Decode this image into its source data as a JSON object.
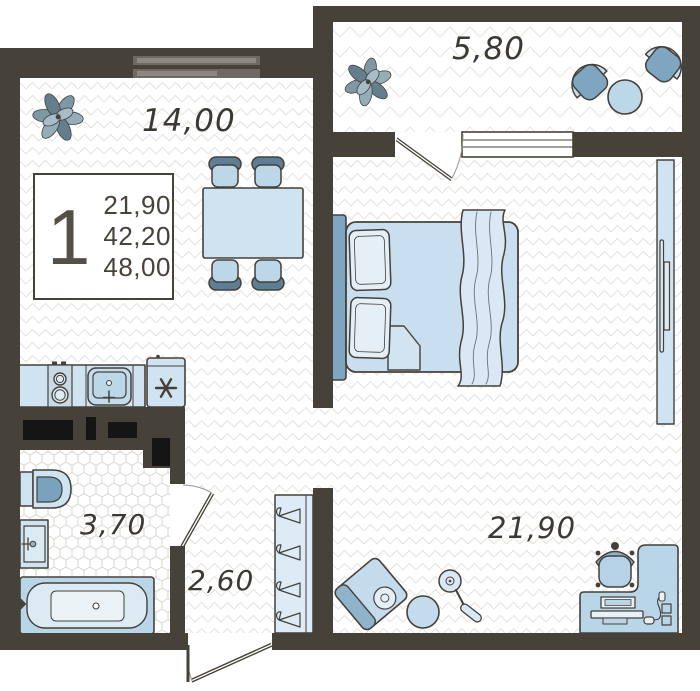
{
  "floor_plan": {
    "unit_card": {
      "room_count": "1",
      "area_line_1": "21,90",
      "area_line_2": "42,20",
      "area_line_3": "48,00"
    },
    "room_labels": {
      "kitchen_living": "14,00",
      "balcony": "5,80",
      "bedroom": "21,90",
      "bathroom": "3,70",
      "hallway": "2,60"
    },
    "icons": {
      "freezer": "snowflake-asterisk-icon",
      "wardrobe": "clothes-hanger-icon",
      "plants": "potted-plant-icon"
    },
    "colors": {
      "wall": "#474239",
      "furniture_light": "#cfe3f0",
      "furniture_pale": "#e2eef7",
      "furniture_mid": "#8fb3cb",
      "furniture_dark": "#5d7e95",
      "shaft": "#151515",
      "floor": "#ffffff"
    }
  }
}
